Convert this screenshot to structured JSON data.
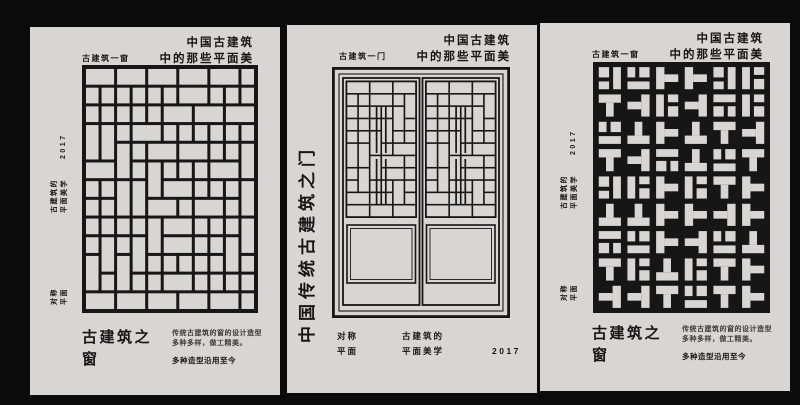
{
  "canvas": {
    "background": "#0b0b0b",
    "poster_background": "#d7d6d3",
    "ink": "#161616"
  },
  "shared": {
    "title_line1": "中国古建筑",
    "title_line2": "中的那些平面美",
    "year": "2017",
    "aesthetic_line1": "古建筑的",
    "aesthetic_line2": "平面美学",
    "symmetry_line1": "对称",
    "symmetry_line2": "平面"
  },
  "window_poster": {
    "label": "古建筑一窗",
    "big_title_line1": "古建筑之",
    "big_title_line2": "窗",
    "desc_line1": "传统古建筑的窗的设计造型",
    "desc_line2": "多种多样，做工精美。",
    "desc_bold": "多种造型沿用至今"
  },
  "door_poster": {
    "label": "古建筑一门",
    "vertical_title": "中国传统古建筑之门"
  },
  "graphics": {
    "window_left": "brick-grid-lattice",
    "door": "double-door-lattice",
    "window_right": "t-fret-lattice"
  }
}
